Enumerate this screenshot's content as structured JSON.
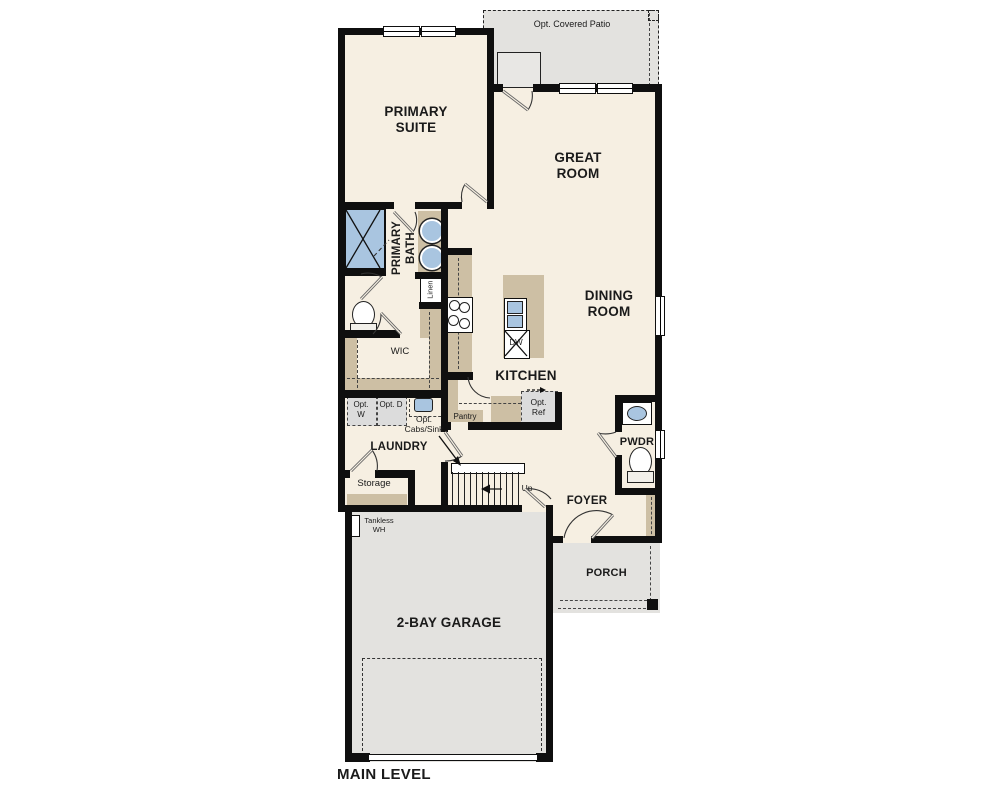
{
  "title": "MAIN LEVEL",
  "floorplan": {
    "rooms": {
      "primary_suite": "PRIMARY SUITE",
      "great_room": "GREAT ROOM",
      "dining_room": "DINING ROOM",
      "primary_bath": "PRIMARY BATH",
      "wic": "WIC",
      "kitchen": "KITCHEN",
      "laundry": "LAUNDRY",
      "storage": "Storage",
      "pwdr": "PWDR",
      "foyer": "FOYER",
      "porch": "PORCH",
      "garage": "2-BAY GARAGE"
    },
    "features": {
      "opt_covered_patio": "Opt. Covered Patio",
      "linen": "Linen",
      "pantry": "Pantry",
      "dishwasher": "DW",
      "opt_washer": "Opt. W",
      "opt_dryer": "Opt. D",
      "opt_cabs_sink": "Opt. Cabs/Sink",
      "opt_ref": "Opt. Ref",
      "stairs_up": "Up",
      "tankless_wh": "Tankless WH"
    },
    "colors": {
      "floor": "#f6efe2",
      "cabinetry": "#cdbfa4",
      "exterior_concrete": "#e3e2df",
      "fixture_blue": "#a9c5e0",
      "wall": "#0f0f0f",
      "optional_fill": "#dcdcdc"
    }
  }
}
